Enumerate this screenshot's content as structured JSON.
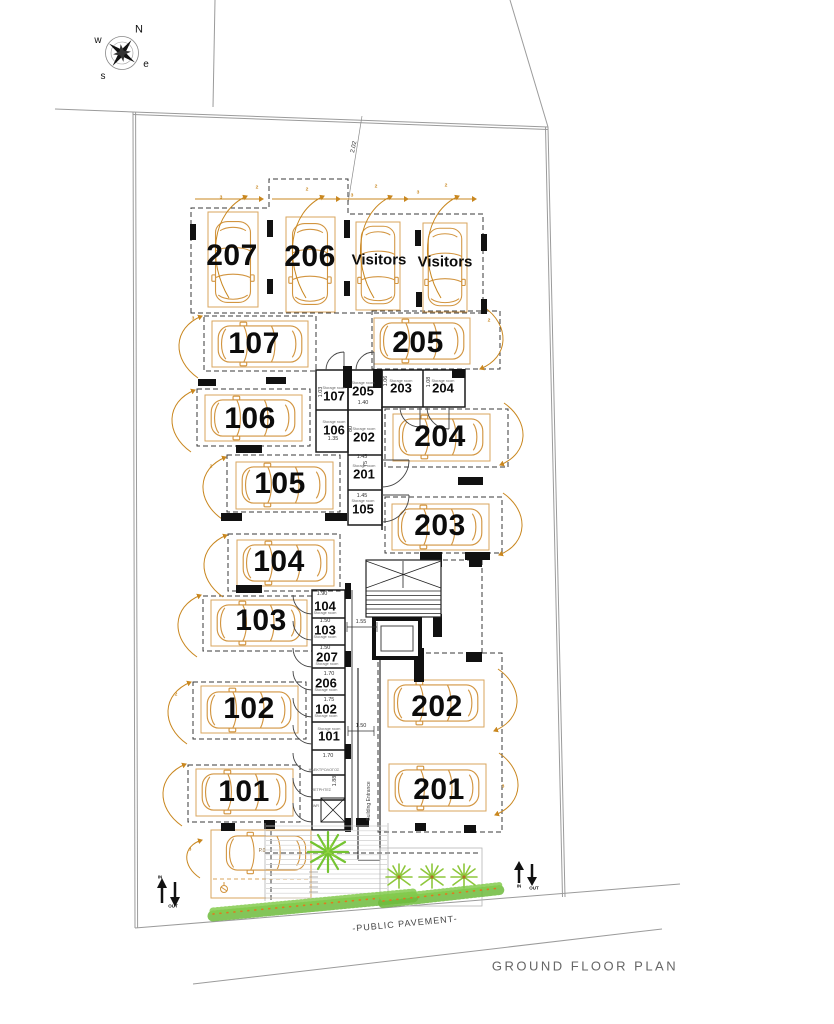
{
  "drawing": {
    "title": "GROUND FLOOR PLAN",
    "pavement_label": "-PUBLIC PAVEMENT-",
    "site_dimension": "2.02",
    "building_entrance": "Building Entrance",
    "compass": {
      "n": "N",
      "e": "e",
      "s": "s",
      "w": "w"
    },
    "circulation": {
      "in": "IN",
      "out": "OUT"
    },
    "parking": {
      "top": [
        "207",
        "206",
        "Visitors",
        "Visitors"
      ],
      "left": [
        "107",
        "106",
        "105",
        "104",
        "103",
        "102",
        "101"
      ],
      "right": [
        "205",
        "204",
        "203",
        "202",
        "201"
      ],
      "accessible": "P.0"
    },
    "storage": {
      "room_label": "Storage room",
      "upper": [
        "107",
        "205",
        "203",
        "204",
        "106",
        "202",
        "201",
        "105"
      ],
      "lower": [
        "104",
        "103",
        "207",
        "206",
        "102",
        "101"
      ],
      "utility": [
        "ΗΛΕΚΤΡΟΛΟΓΟΣ",
        "ΜΕΤΡΗΤΕΣ",
        "WR"
      ]
    },
    "dimensions": {
      "d103": "1.03",
      "d106": "1.06",
      "d108": "1.08",
      "d135": "1.35",
      "d140": "1.40",
      "d145": "1.45",
      "d150": "1.50",
      "d155": "1.55",
      "d170": "1.70",
      "d175": "1.75",
      "d188": "1.88",
      "d190": "1.90",
      "d75": "75",
      "d80": "80"
    },
    "maneuver": {
      "m1": "1",
      "m2": "2",
      "m3": "3"
    },
    "colors": {
      "car": "#d29540",
      "arrow": "#c9871f",
      "plant": "#74c431",
      "flower": "#e07820"
    }
  }
}
